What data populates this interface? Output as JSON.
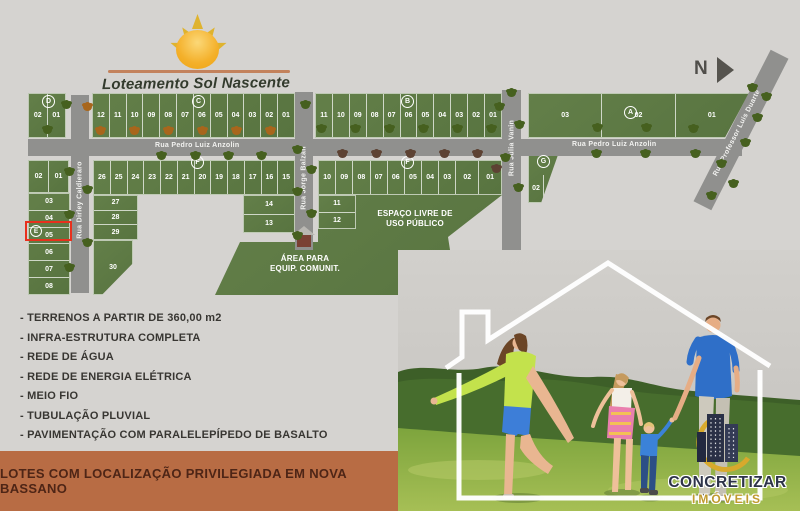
{
  "header": {
    "title": "Loteamento Sol Nascente"
  },
  "compass": {
    "north_label": "N"
  },
  "map": {
    "streets": {
      "pedro_left": "Rua Pedro Luiz Anzolin",
      "pedro_right": "Rua Pedro Luiz Anzolin",
      "dirley": "Rua Dirley Caldieraro",
      "jorge": "Rua Jorge Balzan",
      "julia": "Rua Julia Vanin",
      "professor": "Rua Professor Luis Duarte"
    },
    "block_labels": {
      "a": "A",
      "b": "B",
      "c": "C",
      "d": "D",
      "e": "E",
      "f_west": "F",
      "f_east": "F",
      "g": "G"
    },
    "lots": {
      "d": [
        "02",
        "01"
      ],
      "c": [
        "12",
        "11",
        "10",
        "09",
        "08",
        "07",
        "06",
        "05",
        "04",
        "03",
        "02",
        "01"
      ],
      "b": [
        "11",
        "10",
        "09",
        "08",
        "07",
        "06",
        "05",
        "04",
        "03",
        "02",
        "01"
      ],
      "a": [
        "03",
        "02",
        "01"
      ],
      "e_top": [
        "02",
        "01"
      ],
      "e_col": [
        "03",
        "04",
        "05",
        "06",
        "07",
        "08"
      ],
      "f_west_top": [
        "26",
        "25",
        "24",
        "23",
        "22",
        "21",
        "20",
        "19",
        "18",
        "17",
        "16",
        "15"
      ],
      "f_west_left": [
        "27",
        "28",
        "29"
      ],
      "f_west_bottom": [
        "30"
      ],
      "f_west_right": [
        "14",
        "13"
      ],
      "f_east_top": [
        "10",
        "09",
        "08",
        "07",
        "06",
        "05",
        "04",
        "03",
        "02",
        "01"
      ],
      "f_east_left": [
        "11",
        "12"
      ],
      "g": [
        "02",
        "01"
      ]
    },
    "areas": {
      "public_line1": "ESPAÇO LIVRE DE",
      "public_line2": "USO PÚBLICO",
      "equip_line1": "ÁREA PARA",
      "equip_line2": "EQUIP. COMUNIT."
    },
    "highlight": {
      "block": "E",
      "lot": "05"
    }
  },
  "features": {
    "items": [
      "- TERRENOS A PARTIR DE 360,00 m2",
      "- INFRA-ESTRUTURA COMPLETA",
      "- REDE DE ÁGUA",
      "- REDE DE ENERGIA ELÉTRICA",
      "- MEIO FIO",
      "- TUBULAÇÃO PLUVIAL",
      "- PAVIMENTAÇÃO COM PARALELEPÍPEDO DE BASALTO"
    ]
  },
  "banner": {
    "text": "LOTES COM LOCALIZAÇÃO PRIVILEGIADA EM NOVA BASSANO"
  },
  "brand": {
    "name": "CONCRETIZAR",
    "subtitle": "IMÓVEIS"
  },
  "colors": {
    "highlight_red": "#e8301d",
    "banner_bg": "#b86c44",
    "block_green": "#5d7c44",
    "street_gray": "#90908e",
    "sun_gold": "#f4b02a",
    "logo_navy": "#2d3348",
    "logo_gold": "#c09a2e"
  }
}
